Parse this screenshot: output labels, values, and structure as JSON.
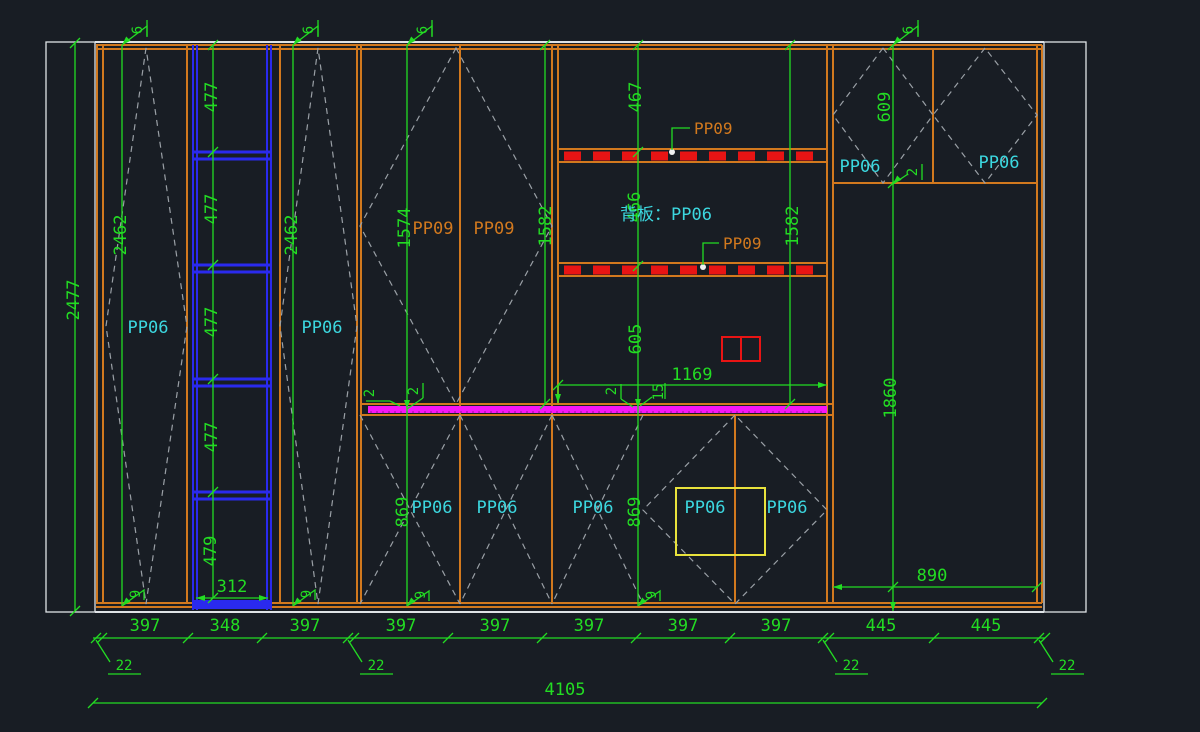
{
  "colors": {
    "background": "#181d24",
    "dimension_green": "#23dc23",
    "panel_orange": "#d2791e",
    "label_cyan": "#3cd8e0",
    "label_orange": "#d2791e",
    "ladder_blue": "#2a2aee",
    "highlight_magenta": "#f716f7",
    "hatch_red": "#e81414",
    "box_yellow": "#e8e23c",
    "wall_white": "#dfe3e6",
    "dashed_gray": "#9aa0a6",
    "concrete_speck": "#8b9096"
  },
  "labels": {
    "pp06_left": [
      "PP06",
      "PP06"
    ],
    "pp09_upper": [
      "PP09",
      "PP09"
    ],
    "backboard": "背板：PP06",
    "pp09_callouts": [
      "PP09",
      "PP09"
    ],
    "pp06_right": [
      "PP06",
      "PP06"
    ],
    "pp06_bottom": [
      "PP06",
      "PP06",
      "PP06",
      "PP06",
      "PP06"
    ]
  },
  "dims": {
    "overall": "4105",
    "left_outer": "2477",
    "left_inner": [
      "2462",
      "2462"
    ],
    "ladder": [
      "477",
      "477",
      "477",
      "477",
      "479"
    ],
    "ladder_width": "312",
    "upper": [
      "1574",
      "1582",
      "1582"
    ],
    "back": [
      "467",
      "466",
      "605"
    ],
    "back_width": "1169",
    "gap": "15",
    "lower": [
      "869",
      "869"
    ],
    "right": [
      "609",
      "1860",
      "890"
    ],
    "bottom_row": [
      "397",
      "348",
      "397",
      "397",
      "397",
      "397",
      "397",
      "397",
      "445",
      "445"
    ],
    "t22": [
      "22",
      "22",
      "22",
      "22"
    ],
    "t6": [
      "6",
      "6",
      "6",
      "6"
    ],
    "t9": [
      "9",
      "9",
      "9",
      "9"
    ],
    "t2": [
      "2",
      "2",
      "2",
      "2"
    ]
  }
}
